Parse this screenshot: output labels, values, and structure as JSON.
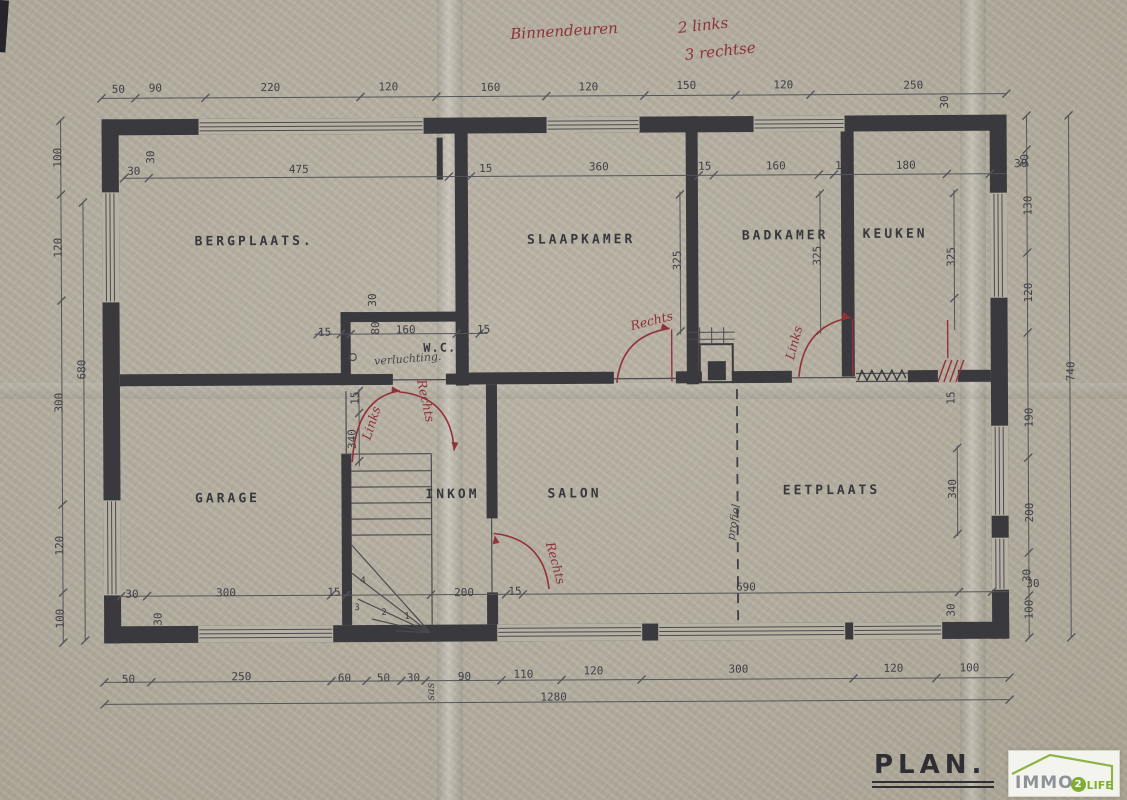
{
  "title_block": {
    "plan": "PLAN."
  },
  "logo": {
    "brand": "IMMO",
    "num": "2",
    "suffix": "LIFE"
  },
  "colors": {
    "paper": "#b6b0a3",
    "wall": "#3a393d",
    "red_annotation": "#8e3139",
    "logo_green": "#7fae33"
  },
  "labels": [
    {
      "t": "Binnendeuren",
      "x": 566,
      "y": 31,
      "k": "red",
      "r": -3,
      "n": "note-binnendeuren"
    },
    {
      "t": "2 links",
      "x": 705,
      "y": 26,
      "k": "red",
      "r": -6,
      "n": "note-2-links"
    },
    {
      "t": "3 rechtse",
      "x": 722,
      "y": 52,
      "k": "red",
      "r": -6,
      "n": "note-3-rechtse"
    },
    {
      "t": "BERGPLAATS.",
      "x": 255,
      "y": 240,
      "k": "room",
      "n": "room-label-bergplaats"
    },
    {
      "t": "SLAAPKAMER",
      "x": 582,
      "y": 240,
      "k": "room",
      "n": "room-label-slaapkamer"
    },
    {
      "t": "BADKAMER",
      "x": 786,
      "y": 237,
      "k": "room",
      "n": "room-label-badkamer"
    },
    {
      "t": "KEUKEN",
      "x": 896,
      "y": 236,
      "k": "room",
      "n": "room-label-keuken"
    },
    {
      "t": "W.C.",
      "x": 440,
      "y": 347,
      "k": "roomsm",
      "n": "room-label-wc"
    },
    {
      "t": "GARAGE",
      "x": 227,
      "y": 497,
      "k": "room",
      "n": "room-label-garage"
    },
    {
      "t": "INKOM",
      "x": 452,
      "y": 494,
      "k": "room",
      "n": "room-label-inkom"
    },
    {
      "t": "SALON",
      "x": 574,
      "y": 494,
      "k": "room",
      "n": "room-label-salon"
    },
    {
      "t": "EETPLAATS",
      "x": 831,
      "y": 492,
      "k": "room",
      "n": "room-label-eetplaats"
    },
    {
      "t": "verluchting.",
      "x": 408,
      "y": 358,
      "k": "hand",
      "r": -4,
      "n": "note-verluchting"
    },
    {
      "t": "profiel",
      "x": 733,
      "y": 523,
      "k": "hand",
      "r": -80,
      "n": "note-profiel"
    },
    {
      "t": "sas",
      "x": 429,
      "y": 691,
      "k": "hand",
      "r": -90,
      "n": "note-sas"
    },
    {
      "t": "Rechts",
      "x": 652,
      "y": 321,
      "k": "redsm",
      "r": -14,
      "n": "door-label-rechts-slaapkamer"
    },
    {
      "t": "Links",
      "x": 794,
      "y": 344,
      "k": "redsm",
      "r": -75,
      "n": "door-label-links-keuken"
    },
    {
      "t": "Links",
      "x": 371,
      "y": 422,
      "k": "redsm",
      "r": -72,
      "n": "door-label-links-wc"
    },
    {
      "t": "Rechts",
      "x": 426,
      "y": 400,
      "k": "redsm",
      "r": 78,
      "n": "door-label-rechts-inkom"
    },
    {
      "t": "Rechts",
      "x": 555,
      "y": 563,
      "k": "redsm",
      "r": 75,
      "n": "door-label-rechts-salon"
    },
    {
      "t": "50",
      "x": 120,
      "y": 87,
      "k": "dim"
    },
    {
      "t": "90",
      "x": 157,
      "y": 86,
      "k": "dim"
    },
    {
      "t": "220",
      "x": 272,
      "y": 86,
      "k": "dim"
    },
    {
      "t": "120",
      "x": 390,
      "y": 86,
      "k": "dim"
    },
    {
      "t": "160",
      "x": 492,
      "y": 87,
      "k": "dim"
    },
    {
      "t": "120",
      "x": 590,
      "y": 87,
      "k": "dim"
    },
    {
      "t": "150",
      "x": 688,
      "y": 86,
      "k": "dim"
    },
    {
      "t": "120",
      "x": 785,
      "y": 86,
      "k": "dim"
    },
    {
      "t": "250",
      "x": 915,
      "y": 87,
      "k": "dim"
    },
    {
      "t": "30",
      "x": 946,
      "y": 104,
      "k": "dim",
      "r": -90
    },
    {
      "t": "30",
      "x": 135,
      "y": 169,
      "k": "dim"
    },
    {
      "t": "30",
      "x": 152,
      "y": 155,
      "k": "dim",
      "r": -90
    },
    {
      "t": "475",
      "x": 300,
      "y": 168,
      "k": "dim"
    },
    {
      "t": "15",
      "x": 487,
      "y": 168,
      "k": "dim"
    },
    {
      "t": "360",
      "x": 600,
      "y": 167,
      "k": "dim"
    },
    {
      "t": "15",
      "x": 706,
      "y": 167,
      "k": "dim"
    },
    {
      "t": "160",
      "x": 777,
      "y": 167,
      "k": "dim"
    },
    {
      "t": "15",
      "x": 843,
      "y": 167,
      "k": "dim"
    },
    {
      "t": "180",
      "x": 907,
      "y": 167,
      "k": "dim"
    },
    {
      "t": "30",
      "x": 1022,
      "y": 166,
      "k": "dim"
    },
    {
      "t": "325",
      "x": 678,
      "y": 261,
      "k": "dim",
      "r": -90
    },
    {
      "t": "325",
      "x": 818,
      "y": 257,
      "k": "dim",
      "r": -90
    },
    {
      "t": "325",
      "x": 952,
      "y": 259,
      "k": "dim",
      "r": -90
    },
    {
      "t": "15",
      "x": 325,
      "y": 331,
      "k": "dim"
    },
    {
      "t": "30",
      "x": 373,
      "y": 299,
      "k": "dim",
      "r": -90
    },
    {
      "t": "80",
      "x": 376,
      "y": 327,
      "k": "dim",
      "r": -90
    },
    {
      "t": "160",
      "x": 406,
      "y": 329,
      "k": "dim"
    },
    {
      "t": "15",
      "x": 484,
      "y": 329,
      "k": "dim"
    },
    {
      "t": "15",
      "x": 355,
      "y": 397,
      "k": "dim",
      "r": -90
    },
    {
      "t": "340",
      "x": 352,
      "y": 438,
      "k": "dim",
      "r": -90
    },
    {
      "t": "15",
      "x": 951,
      "y": 400,
      "k": "dim",
      "r": -90
    },
    {
      "t": "340",
      "x": 952,
      "y": 491,
      "k": "dim",
      "r": -90
    },
    {
      "t": "100",
      "x": 59,
      "y": 155,
      "k": "dim",
      "r": -90
    },
    {
      "t": "120",
      "x": 59,
      "y": 245,
      "k": "dim",
      "r": -90
    },
    {
      "t": "300",
      "x": 59,
      "y": 400,
      "k": "dim",
      "r": -90
    },
    {
      "t": "120",
      "x": 59,
      "y": 543,
      "k": "dim",
      "r": -90
    },
    {
      "t": "100",
      "x": 59,
      "y": 616,
      "k": "dim",
      "r": -90
    },
    {
      "t": "680",
      "x": 82,
      "y": 367,
      "k": "dim",
      "r": -90
    },
    {
      "t": "30",
      "x": 1026,
      "y": 163,
      "k": "dim",
      "r": -90
    },
    {
      "t": "130",
      "x": 1029,
      "y": 208,
      "k": "dim",
      "r": -90
    },
    {
      "t": "120",
      "x": 1029,
      "y": 295,
      "k": "dim",
      "r": -90
    },
    {
      "t": "190",
      "x": 1029,
      "y": 420,
      "k": "dim",
      "r": -90
    },
    {
      "t": "200",
      "x": 1029,
      "y": 515,
      "k": "dim",
      "r": -90
    },
    {
      "t": "30",
      "x": 1026,
      "y": 578,
      "k": "dim",
      "r": -90
    },
    {
      "t": "100",
      "x": 1028,
      "y": 612,
      "k": "dim",
      "r": -90
    },
    {
      "t": "740",
      "x": 1071,
      "y": 374,
      "k": "dim",
      "r": -90
    },
    {
      "t": "30",
      "x": 131,
      "y": 592,
      "k": "dim"
    },
    {
      "t": "30",
      "x": 157,
      "y": 617,
      "k": "dim",
      "r": -90
    },
    {
      "t": "300",
      "x": 225,
      "y": 591,
      "k": "dim"
    },
    {
      "t": "15",
      "x": 333,
      "y": 591,
      "k": "dim"
    },
    {
      "t": "200",
      "x": 463,
      "y": 592,
      "k": "dim"
    },
    {
      "t": "15",
      "x": 514,
      "y": 591,
      "k": "dim"
    },
    {
      "t": "690",
      "x": 745,
      "y": 588,
      "k": "dim"
    },
    {
      "t": "30",
      "x": 1032,
      "y": 586,
      "k": "dim"
    },
    {
      "t": "30",
      "x": 950,
      "y": 612,
      "k": "dim",
      "r": -90
    },
    {
      "t": "4",
      "x": 362,
      "y": 580,
      "k": "small"
    },
    {
      "t": "3",
      "x": 356,
      "y": 607,
      "k": "small"
    },
    {
      "t": "2",
      "x": 383,
      "y": 612,
      "k": "small"
    },
    {
      "t": "1",
      "x": 406,
      "y": 616,
      "k": "small"
    },
    {
      "t": "50",
      "x": 127,
      "y": 677,
      "k": "dim"
    },
    {
      "t": "250",
      "x": 240,
      "y": 675,
      "k": "dim"
    },
    {
      "t": "60",
      "x": 343,
      "y": 677,
      "k": "dim"
    },
    {
      "t": "50",
      "x": 382,
      "y": 677,
      "k": "dim"
    },
    {
      "t": "30",
      "x": 412,
      "y": 677,
      "k": "dim"
    },
    {
      "t": "90",
      "x": 463,
      "y": 676,
      "k": "dim"
    },
    {
      "t": "110",
      "x": 522,
      "y": 674,
      "k": "dim"
    },
    {
      "t": "120",
      "x": 592,
      "y": 671,
      "k": "dim"
    },
    {
      "t": "300",
      "x": 737,
      "y": 670,
      "k": "dim"
    },
    {
      "t": "120",
      "x": 892,
      "y": 670,
      "k": "dim"
    },
    {
      "t": "100",
      "x": 968,
      "y": 670,
      "k": "dim"
    },
    {
      "t": "1280",
      "x": 552,
      "y": 697,
      "k": "dim"
    }
  ]
}
